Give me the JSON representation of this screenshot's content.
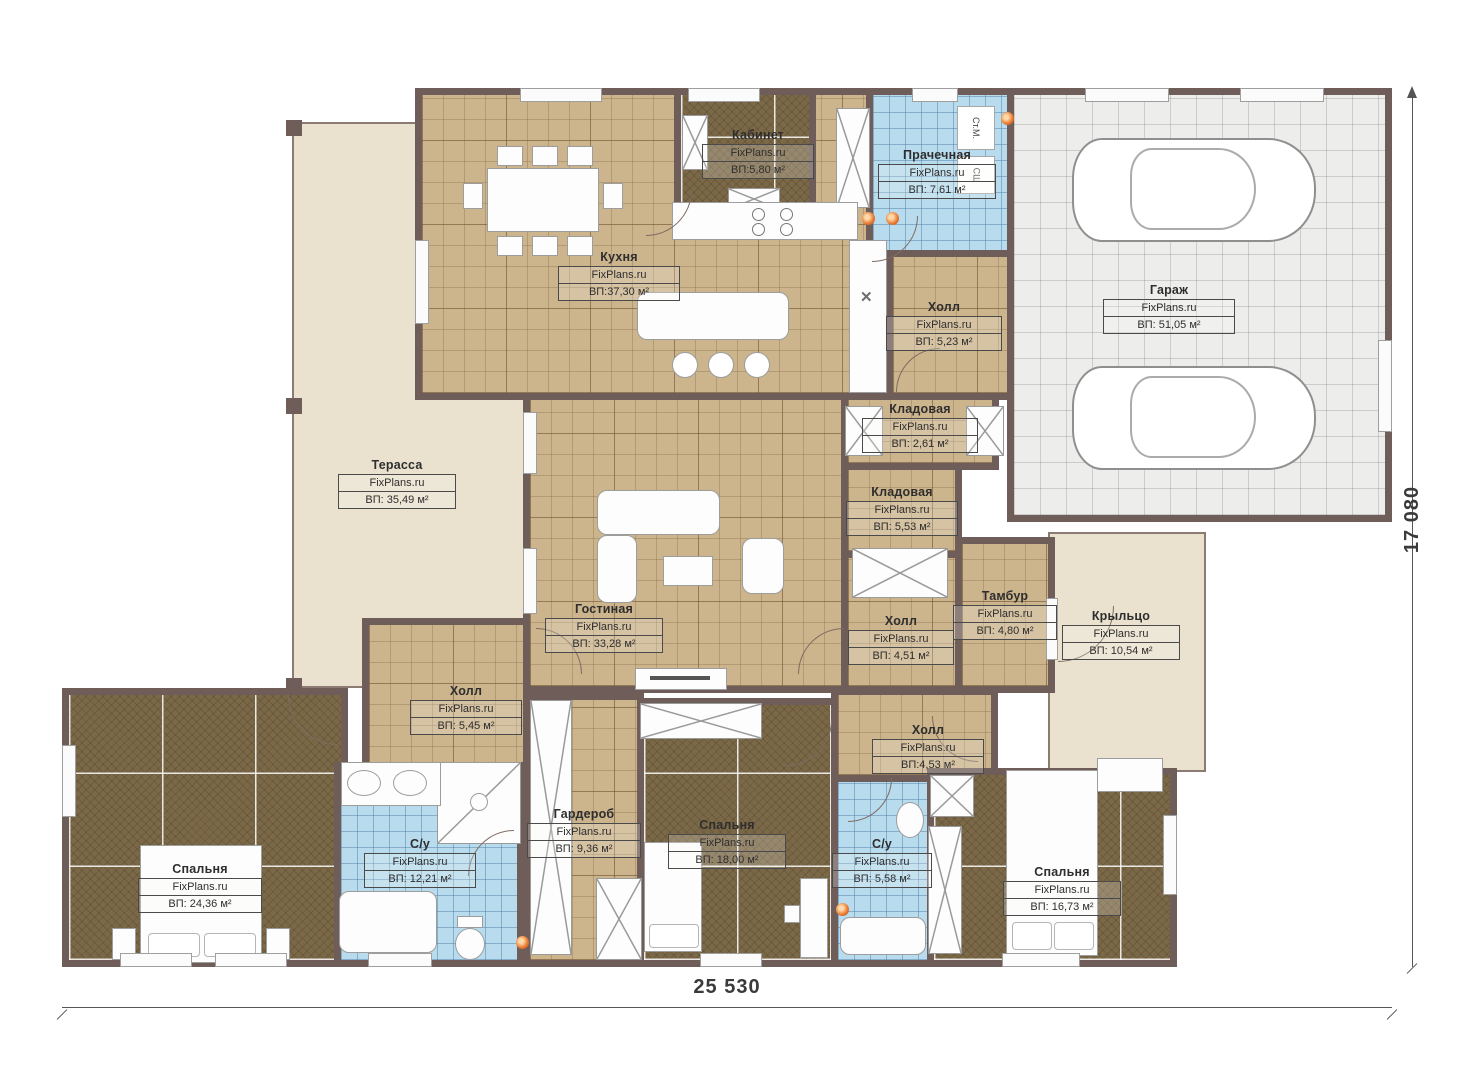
{
  "watermark": "FixPlans.ru",
  "rooms": [
    {
      "name": "Кабинет",
      "area": "ВП:5,80 м²"
    },
    {
      "name": "Прачечная",
      "area": "ВП: 7,61 м²"
    },
    {
      "name": "Кухня",
      "area": "ВП:37,30 м²"
    },
    {
      "name": "Холл",
      "area": "ВП: 5,23 м²"
    },
    {
      "name": "Гараж",
      "area": "ВП: 51,05 м²"
    },
    {
      "name": "Терасса",
      "area": "ВП: 35,49 м²"
    },
    {
      "name": "Кладовая",
      "area": "ВП: 2,61 м²"
    },
    {
      "name": "Кладовая",
      "area": "ВП: 5,53 м²"
    },
    {
      "name": "Гостиная",
      "area": "ВП: 33,28 м²"
    },
    {
      "name": "Холл",
      "area": "ВП: 4,51 м²"
    },
    {
      "name": "Тамбур",
      "area": "ВП: 4,80 м²"
    },
    {
      "name": "Крыльцо",
      "area": "ВП: 10,54 м²"
    },
    {
      "name": "Холл",
      "area": "ВП: 5,45 м²"
    },
    {
      "name": "Холл",
      "area": "ВП:4,53 м²"
    },
    {
      "name": "Гардероб",
      "area": "ВП: 9,36 м²"
    },
    {
      "name": "Спальня",
      "area": "ВП: 18,00 м²"
    },
    {
      "name": "С/у",
      "area": "ВП: 12,21 м²"
    },
    {
      "name": "С/у",
      "area": "ВП: 5,58 м²"
    },
    {
      "name": "Спальня",
      "area": "ВП: 24,36 м²"
    },
    {
      "name": "Спальня",
      "area": "ВП: 16,73 м²"
    }
  ],
  "appliances": {
    "washer": "Ст.М.",
    "dryer": "СШ"
  },
  "dimensions": {
    "width": "25 530",
    "height": "17 080"
  },
  "colors": {
    "wall": "#6f5d59",
    "tile_tan": "#ccb48c",
    "carpet": "#7b6847",
    "tile_blue": "#b9dbee",
    "garage": "#ededec",
    "deck": "#eae2cf",
    "accent_orange": "#e8762d"
  }
}
